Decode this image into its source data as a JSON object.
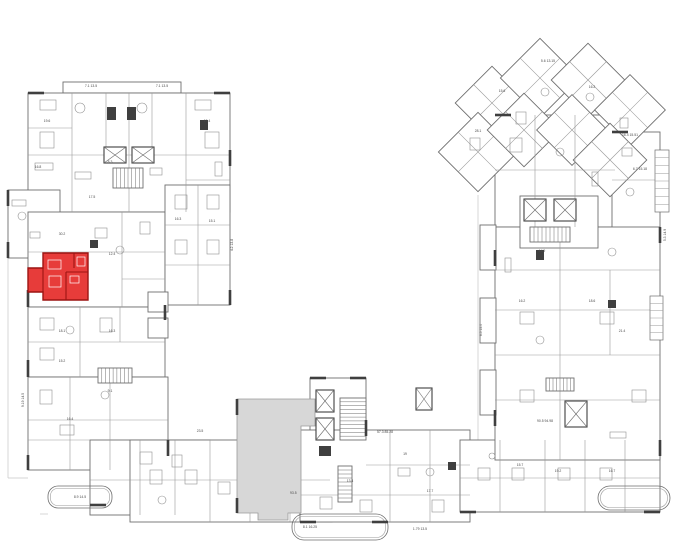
{
  "canvas": {
    "width": 680,
    "height": 551
  },
  "colors": {
    "background": "#ffffff",
    "wall_thick": "#3f3f3f",
    "wall": "#6e6e6e",
    "wall_light": "#9a9a9a",
    "thin_line": "#c6c6c6",
    "furniture": "#8f8f8f",
    "label": "#4a4a4a",
    "highlight_fill": "#e73c3a",
    "highlight_wall": "#9c1412",
    "highlight_furn": "#ffffff",
    "gray_area_fill": "#d7d7d7",
    "gray_area_line": "#9a9a9a"
  },
  "selected_unit": {
    "polygon": [
      43,
      253,
      88,
      253,
      88,
      300,
      43,
      300,
      43,
      292,
      28,
      292,
      28,
      268,
      43,
      268
    ],
    "walls": [
      [
        66,
        272,
        88,
        272
      ],
      [
        66,
        272,
        66,
        300
      ],
      [
        74,
        253,
        74,
        268
      ],
      [
        43,
        268,
        43,
        292
      ]
    ],
    "furniture": [
      [
        48,
        260,
        13,
        9
      ],
      [
        49,
        276,
        12,
        11
      ],
      [
        70,
        276,
        9,
        7
      ],
      [
        77,
        257,
        8,
        9
      ]
    ]
  },
  "gray_area": {
    "polygon": [
      237,
      399,
      315,
      399,
      315,
      426,
      301,
      426,
      301,
      513,
      288,
      513,
      288,
      520,
      258,
      520,
      258,
      513,
      237,
      513
    ],
    "label": "93.5",
    "label_x": 290,
    "label_y": 494
  },
  "blocks": [
    [
      63,
      82,
      118,
      11
    ],
    [
      28,
      93,
      202,
      119
    ],
    [
      8,
      190,
      52,
      68
    ],
    [
      28,
      212,
      137,
      95
    ],
    [
      165,
      185,
      65,
      120
    ],
    [
      28,
      307,
      137,
      70
    ],
    [
      148,
      292,
      20,
      20
    ],
    [
      148,
      318,
      20,
      20
    ],
    [
      28,
      377,
      140,
      93
    ],
    [
      90,
      440,
      120,
      75
    ],
    [
      130,
      440,
      202,
      82
    ],
    [
      310,
      378,
      56,
      84
    ],
    [
      300,
      430,
      170,
      92
    ],
    [
      460,
      440,
      200,
      72
    ],
    [
      495,
      115,
      120,
      112
    ],
    [
      612,
      132,
      48,
      96
    ],
    [
      495,
      227,
      165,
      233
    ],
    [
      520,
      196,
      78,
      52
    ],
    [
      480,
      225,
      16,
      45
    ],
    [
      480,
      298,
      16,
      45
    ],
    [
      480,
      370,
      16,
      45
    ]
  ],
  "diagonal_blocks": [
    [
      492,
      103,
      52
    ],
    [
      540,
      78,
      56
    ],
    [
      588,
      80,
      52
    ],
    [
      630,
      110,
      50
    ],
    [
      478,
      152,
      56
    ],
    [
      524,
      130,
      52
    ],
    [
      572,
      130,
      50
    ],
    [
      610,
      160,
      52
    ]
  ],
  "partitions": [
    [
      72,
      93,
      72,
      212
    ],
    [
      106,
      93,
      106,
      155
    ],
    [
      129,
      93,
      129,
      212
    ],
    [
      152,
      93,
      152,
      155
    ],
    [
      186,
      93,
      186,
      212
    ],
    [
      28,
      155,
      230,
      155
    ],
    [
      28,
      128,
      72,
      128
    ],
    [
      186,
      180,
      230,
      180
    ],
    [
      28,
      252,
      165,
      252
    ],
    [
      122,
      212,
      122,
      307
    ],
    [
      122,
      279,
      165,
      279
    ],
    [
      165,
      225,
      230,
      225
    ],
    [
      165,
      265,
      230,
      265
    ],
    [
      198,
      185,
      198,
      305
    ],
    [
      28,
      342,
      165,
      342
    ],
    [
      80,
      307,
      80,
      377
    ],
    [
      120,
      307,
      120,
      342
    ],
    [
      70,
      377,
      70,
      470
    ],
    [
      110,
      377,
      110,
      470
    ],
    [
      28,
      420,
      168,
      420
    ],
    [
      28,
      440,
      90,
      440
    ],
    [
      140,
      440,
      140,
      515
    ],
    [
      175,
      440,
      175,
      515
    ],
    [
      90,
      480,
      330,
      480
    ],
    [
      210,
      440,
      210,
      522
    ],
    [
      250,
      440,
      250,
      522
    ],
    [
      290,
      440,
      290,
      522
    ],
    [
      390,
      430,
      390,
      522
    ],
    [
      430,
      430,
      430,
      522
    ],
    [
      366,
      465,
      470,
      465
    ],
    [
      300,
      495,
      470,
      495
    ],
    [
      500,
      440,
      500,
      512
    ],
    [
      545,
      440,
      545,
      512
    ],
    [
      585,
      440,
      585,
      512
    ],
    [
      625,
      440,
      625,
      512
    ],
    [
      460,
      478,
      660,
      478
    ],
    [
      495,
      270,
      660,
      270
    ],
    [
      495,
      310,
      660,
      310
    ],
    [
      495,
      355,
      660,
      355
    ],
    [
      495,
      400,
      660,
      400
    ],
    [
      560,
      227,
      560,
      460
    ],
    [
      610,
      270,
      610,
      355
    ],
    [
      535,
      115,
      535,
      227
    ],
    [
      575,
      115,
      575,
      227
    ],
    [
      495,
      170,
      615,
      170
    ],
    [
      612,
      180,
      660,
      180
    ]
  ],
  "stairs": [
    {
      "x": 340,
      "y": 398,
      "w": 26,
      "h": 42,
      "n": 11,
      "dir": "h"
    },
    {
      "x": 98,
      "y": 368,
      "w": 34,
      "h": 15,
      "n": 9,
      "dir": "v"
    },
    {
      "x": 530,
      "y": 227,
      "w": 40,
      "h": 15,
      "n": 10,
      "dir": "v"
    },
    {
      "x": 113,
      "y": 168,
      "w": 30,
      "h": 20,
      "n": 8,
      "dir": "v"
    },
    {
      "x": 338,
      "y": 466,
      "w": 14,
      "h": 36,
      "n": 9,
      "dir": "h"
    },
    {
      "x": 546,
      "y": 378,
      "w": 28,
      "h": 13,
      "n": 8,
      "dir": "v"
    }
  ],
  "elevators": [
    [
      316,
      390,
      18,
      22
    ],
    [
      316,
      418,
      18,
      22
    ],
    [
      104,
      147,
      22,
      16
    ],
    [
      132,
      147,
      22,
      16
    ],
    [
      524,
      199,
      22,
      22
    ],
    [
      554,
      199,
      22,
      22
    ],
    [
      565,
      401,
      22,
      26
    ],
    [
      416,
      388,
      16,
      22
    ]
  ],
  "dark_boxes": [
    [
      107,
      107,
      9,
      13
    ],
    [
      127,
      107,
      9,
      13
    ],
    [
      319,
      446,
      12,
      10
    ],
    [
      200,
      120,
      8,
      10
    ],
    [
      536,
      250,
      8,
      10
    ],
    [
      448,
      462,
      8,
      8
    ],
    [
      608,
      300,
      8,
      8
    ],
    [
      90,
      240,
      8,
      8
    ]
  ],
  "balconies": [
    {
      "x": 48,
      "y": 486,
      "w": 64,
      "h": 22,
      "r": 10
    },
    {
      "x": 292,
      "y": 514,
      "w": 96,
      "h": 26,
      "r": 12
    },
    {
      "x": 598,
      "y": 486,
      "w": 72,
      "h": 24,
      "r": 12
    }
  ],
  "hatches": [
    {
      "x": 655,
      "y": 150,
      "w": 14,
      "h": 62,
      "n": 8
    },
    {
      "x": 650,
      "y": 296,
      "w": 13,
      "h": 44,
      "n": 6
    }
  ],
  "furniture_rects": [
    [
      40,
      100,
      16,
      10
    ],
    [
      195,
      100,
      16,
      10
    ],
    [
      40,
      132,
      14,
      16
    ],
    [
      205,
      132,
      14,
      16
    ],
    [
      35,
      163,
      18,
      7
    ],
    [
      75,
      172,
      16,
      7
    ],
    [
      150,
      168,
      12,
      7
    ],
    [
      215,
      162,
      7,
      14
    ],
    [
      12,
      200,
      14,
      6
    ],
    [
      30,
      232,
      10,
      6
    ],
    [
      95,
      228,
      12,
      10
    ],
    [
      140,
      222,
      10,
      12
    ],
    [
      175,
      195,
      12,
      14
    ],
    [
      207,
      195,
      12,
      14
    ],
    [
      175,
      240,
      12,
      14
    ],
    [
      207,
      240,
      12,
      14
    ],
    [
      40,
      318,
      14,
      12
    ],
    [
      40,
      348,
      14,
      12
    ],
    [
      100,
      318,
      12,
      14
    ],
    [
      40,
      390,
      12,
      14
    ],
    [
      60,
      425,
      14,
      10
    ],
    [
      140,
      452,
      12,
      12
    ],
    [
      172,
      455,
      10,
      12
    ],
    [
      150,
      470,
      12,
      14
    ],
    [
      185,
      470,
      12,
      14
    ],
    [
      218,
      482,
      12,
      12
    ],
    [
      398,
      468,
      12,
      8
    ],
    [
      320,
      497,
      12,
      12
    ],
    [
      360,
      500,
      12,
      12
    ],
    [
      432,
      500,
      12,
      12
    ],
    [
      478,
      468,
      12,
      12
    ],
    [
      512,
      468,
      12,
      12
    ],
    [
      558,
      468,
      12,
      12
    ],
    [
      600,
      468,
      12,
      12
    ],
    [
      520,
      312,
      14,
      12
    ],
    [
      600,
      312,
      14,
      12
    ],
    [
      520,
      390,
      14,
      12
    ],
    [
      632,
      390,
      14,
      12
    ],
    [
      610,
      432,
      16,
      6
    ],
    [
      505,
      258,
      6,
      14
    ],
    [
      510,
      138,
      12,
      14
    ],
    [
      592,
      172,
      6,
      14
    ],
    [
      622,
      148,
      10,
      8
    ],
    [
      470,
      138,
      10,
      12
    ],
    [
      516,
      112,
      10,
      12
    ],
    [
      620,
      118,
      8,
      10
    ]
  ],
  "furniture_circles": [
    [
      80,
      108,
      5
    ],
    [
      142,
      108,
      5
    ],
    [
      22,
      216,
      4
    ],
    [
      120,
      250,
      4
    ],
    [
      70,
      330,
      4
    ],
    [
      105,
      395,
      4
    ],
    [
      162,
      500,
      4
    ],
    [
      430,
      472,
      4
    ],
    [
      492,
      456,
      3
    ],
    [
      540,
      340,
      4
    ],
    [
      612,
      252,
      4
    ],
    [
      560,
      152,
      4
    ],
    [
      545,
      92,
      4
    ],
    [
      590,
      97,
      4
    ],
    [
      630,
      192,
      4
    ]
  ],
  "wall_ticks": [
    [
      28,
      93,
      44,
      93
    ],
    [
      214,
      93,
      230,
      93
    ],
    [
      230,
      150,
      230,
      166
    ],
    [
      230,
      290,
      230,
      305
    ],
    [
      165,
      305,
      165,
      320
    ],
    [
      28,
      290,
      28,
      307
    ],
    [
      28,
      360,
      28,
      377
    ],
    [
      8,
      190,
      8,
      206
    ],
    [
      8,
      242,
      8,
      258
    ],
    [
      28,
      455,
      28,
      470
    ],
    [
      90,
      505,
      106,
      505
    ],
    [
      168,
      440,
      168,
      456
    ],
    [
      310,
      378,
      326,
      378
    ],
    [
      350,
      378,
      366,
      378
    ],
    [
      366,
      420,
      366,
      436
    ],
    [
      300,
      522,
      316,
      522
    ],
    [
      372,
      522,
      388,
      522
    ],
    [
      460,
      512,
      476,
      512
    ],
    [
      644,
      512,
      660,
      512
    ],
    [
      660,
      440,
      660,
      456
    ],
    [
      660,
      227,
      660,
      243
    ],
    [
      495,
      250,
      495,
      266
    ],
    [
      495,
      410,
      495,
      426
    ],
    [
      612,
      132,
      628,
      132
    ],
    [
      495,
      115,
      511,
      115
    ],
    [
      237,
      399,
      237,
      415
    ],
    [
      237,
      498,
      237,
      513
    ]
  ],
  "thin_lines": [
    [
      8,
      258,
      8,
      478
    ],
    [
      8,
      478,
      28,
      478
    ],
    [
      478,
      195,
      478,
      440
    ],
    [
      40,
      514,
      48,
      514
    ]
  ],
  "labels": [
    {
      "x": 91,
      "y": 87,
      "t": "7.1 13.5"
    },
    {
      "x": 162,
      "y": 87,
      "t": "7.1 13.5"
    },
    {
      "x": 47,
      "y": 122,
      "t": "19.6"
    },
    {
      "x": 207,
      "y": 122,
      "t": "19.4"
    },
    {
      "x": 38,
      "y": 168,
      "t": "16.8"
    },
    {
      "x": 110,
      "y": 163,
      "t": "8.3"
    },
    {
      "x": 92,
      "y": 198,
      "t": "17.5"
    },
    {
      "x": 62,
      "y": 235,
      "t": "30.2"
    },
    {
      "x": 112,
      "y": 255,
      "t": "12.4"
    },
    {
      "x": 178,
      "y": 220,
      "t": "16.3"
    },
    {
      "x": 212,
      "y": 222,
      "t": "15.1"
    },
    {
      "x": 62,
      "y": 332,
      "t": "18.1"
    },
    {
      "x": 112,
      "y": 332,
      "t": "16.3"
    },
    {
      "x": 62,
      "y": 362,
      "t": "15.2"
    },
    {
      "x": 70,
      "y": 420,
      "t": "16.4"
    },
    {
      "x": 110,
      "y": 392,
      "t": "9.1"
    },
    {
      "x": 200,
      "y": 432,
      "t": "23.5"
    },
    {
      "x": 385,
      "y": 433,
      "t": "57.3 85.28"
    },
    {
      "x": 350,
      "y": 482,
      "t": "13.4"
    },
    {
      "x": 430,
      "y": 492,
      "t": "17.7"
    },
    {
      "x": 405,
      "y": 455,
      "t": "19"
    },
    {
      "x": 520,
      "y": 466,
      "t": "15.7"
    },
    {
      "x": 558,
      "y": 472,
      "t": "19.2"
    },
    {
      "x": 612,
      "y": 472,
      "t": "16.7"
    },
    {
      "x": 310,
      "y": 528,
      "t": "8.1 16.25"
    },
    {
      "x": 420,
      "y": 530,
      "t": "1.79 13.5"
    },
    {
      "x": 630,
      "y": 136,
      "t": "16.4 15.51"
    },
    {
      "x": 640,
      "y": 170,
      "t": "6.7 15.18"
    },
    {
      "x": 542,
      "y": 252,
      "t": "14.9"
    },
    {
      "x": 522,
      "y": 302,
      "t": "16.2"
    },
    {
      "x": 592,
      "y": 302,
      "t": "18.6"
    },
    {
      "x": 622,
      "y": 332,
      "t": "21.4"
    },
    {
      "x": 545,
      "y": 422,
      "t": "90.5 94.98"
    },
    {
      "x": 502,
      "y": 92,
      "t": "15.6"
    },
    {
      "x": 548,
      "y": 62,
      "t": "5.6 13.15"
    },
    {
      "x": 592,
      "y": 88,
      "t": "16.2"
    },
    {
      "x": 478,
      "y": 132,
      "t": "28.1"
    },
    {
      "x": 80,
      "y": 498,
      "t": "8.9 14.5"
    },
    {
      "x": 24,
      "y": 400,
      "t": "9.19 14.5",
      "r": -90
    },
    {
      "x": 233,
      "y": 245,
      "t": "4.2 13.8",
      "r": -90
    },
    {
      "x": 666,
      "y": 235,
      "t": "5.3 14.9",
      "r": -90
    },
    {
      "x": 482,
      "y": 330,
      "t": "6.5 15.0",
      "r": -90
    }
  ]
}
